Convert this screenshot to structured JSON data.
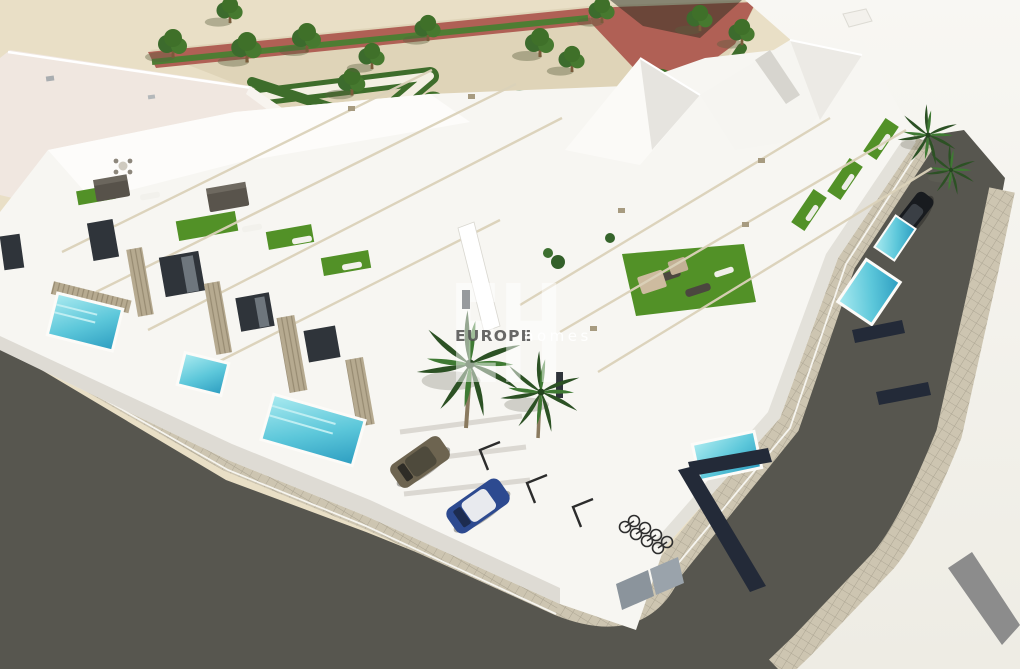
{
  "scene": {
    "type": "architectural-render",
    "description": "Aerial 3D rendering of a modern white residential corner development: townhouses with rooftop terraces (artificial turf, loungers, pergola beams), private turquoise pools behind slatted fences, palm trees, a parking court with two cars and a bicycle rack, wrapped by an asphalt street with paved sidewalks, next to a landscaped park with geometric hedges, trees and red-brick paths"
  },
  "watermark": {
    "monogram": "EH",
    "brand_primary": "EUROPE",
    "brand_secondary": "homes"
  },
  "colors": {
    "sand": "#e9dfc6",
    "gravel": "#dfd4b8",
    "path_red": "#b06055",
    "path_white": "#f4f0e3",
    "hedge": "#3e6d2b",
    "tree": "#3c6b2d",
    "turf": "#529127",
    "pool_light": "#8fe0ea",
    "pool_deep": "#2fa0c4",
    "asphalt": "#57564f",
    "paver": "#cdc5b1",
    "building": "#f7f6f2",
    "roof_pink": "#f0e7e0",
    "facade_shade": "#d9d6cf",
    "fence": "#b6aa90",
    "fence_dark": "#232a38",
    "car_blue": "#2d4a90",
    "car_olive": "#6d6450",
    "watermark_white": "#ffffff",
    "watermark_gray": "#4d4d4d"
  }
}
